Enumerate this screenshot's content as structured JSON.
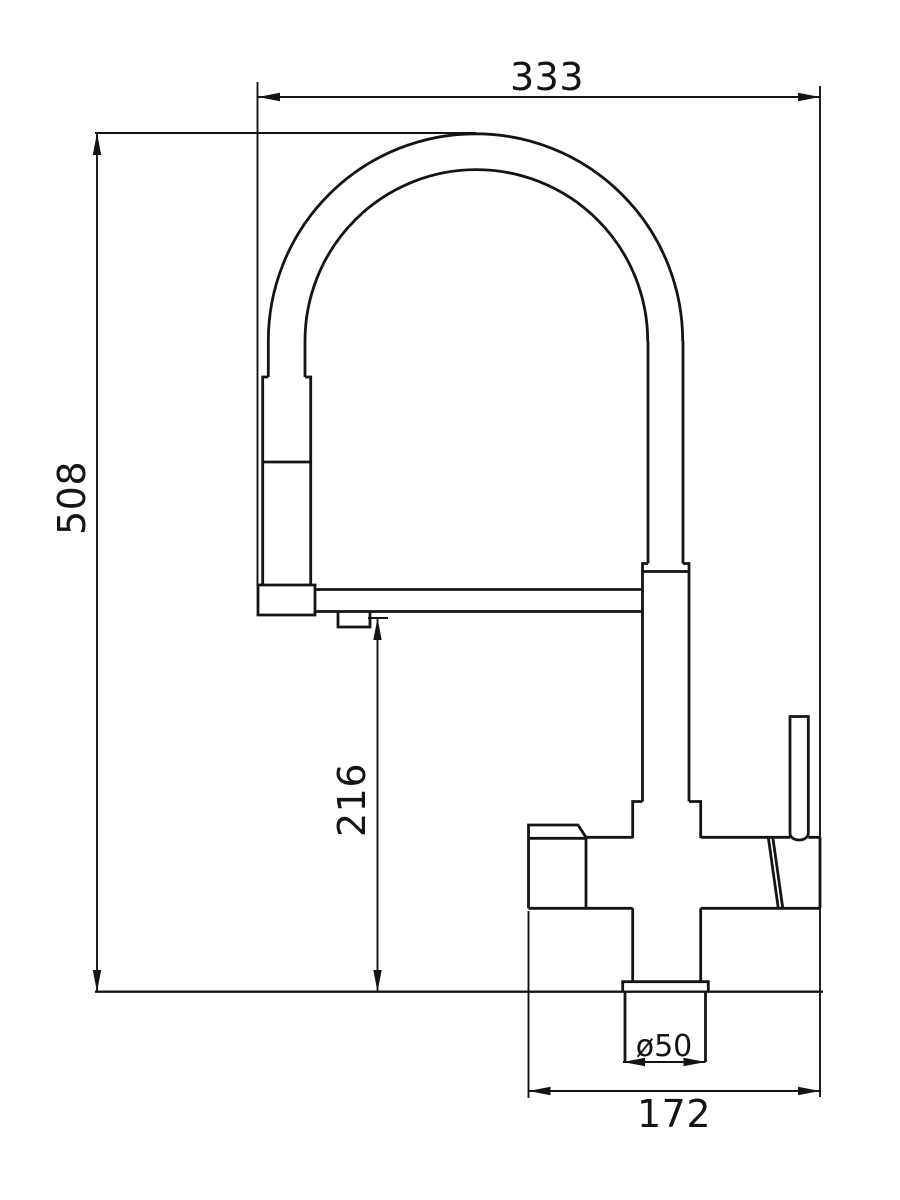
{
  "colors": {
    "background": "#ffffff",
    "line": "#141414"
  },
  "dims": {
    "overall_width": {
      "value": "333"
    },
    "overall_height": {
      "value": "508"
    },
    "spout_underside_height": {
      "value": "216"
    },
    "base_diameter": {
      "value": "ø50"
    },
    "body_span": {
      "value": "172"
    }
  }
}
